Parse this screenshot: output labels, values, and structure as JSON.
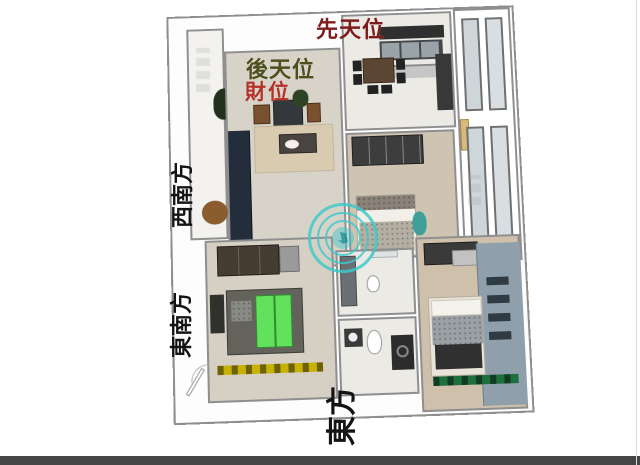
{
  "annotations": {
    "xiantian": {
      "text": "先天位",
      "color": "#7e1c1c"
    },
    "houtian": {
      "text": "後天位",
      "color": "#4c4f1e"
    },
    "caiwei": {
      "text": "財位",
      "color": "#b53028"
    },
    "southwest": {
      "text": "西南方",
      "color": "#141414"
    },
    "southeast": {
      "text": "東南方",
      "color": "#141414"
    },
    "east": {
      "text": "東方",
      "color": "#141414"
    }
  },
  "watermark": {
    "shape": "circular-seal",
    "color": "#3fc9cb"
  },
  "highlights": {
    "bed_green": "#62e25c",
    "bar_yellow": "#c6b104",
    "bar_dark_green": "#1e6e3e"
  }
}
